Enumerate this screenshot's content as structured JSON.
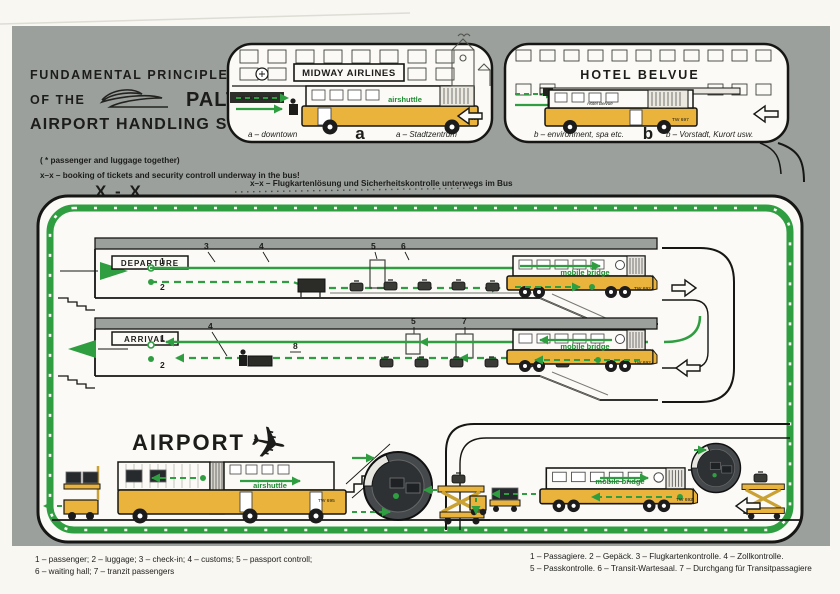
{
  "page": {
    "title1": "FUNDAMENTAL PRINCIPLES",
    "title2a": "OF THE",
    "title2b": "PALT *",
    "title3": "AIRPORT HANDLING SYSTEM",
    "note_star": "( * passenger and luggage together)",
    "note_xx_en": "x–x – booking of tickets and security controll underway in the bus!",
    "note_xx_big": "X - X",
    "note_xx_de": "x–x – Flugkartenlösung und Sicherheitskontrolle unterwegs im Bus"
  },
  "colors": {
    "page_gray": "#9ba09c",
    "green": "#2f9e41",
    "yellow": "#e9b33c",
    "ink": "#161614"
  },
  "scene_a": {
    "sign": "MIDWAY AIRLINES",
    "small_sign": "DEPARTURES",
    "bus_label": "airshuttle",
    "bus_number": "TW 696",
    "caption_left": "a – downtown",
    "letter": "a",
    "caption_right": "a – Stadtzentrum"
  },
  "scene_b": {
    "sign": "HOTEL BELVUE",
    "bus_side_text": "Hotel Belvue",
    "bus_number": "TW 697",
    "caption_left": "b – environment, spa etc.",
    "letter": "b",
    "caption_right": "b – Vorstadt, Kurort usw."
  },
  "departure": {
    "label": "DEPARTURE",
    "n1": "1",
    "n2": "2",
    "n3": "3",
    "n4": "4",
    "n5": "5",
    "n6": "6",
    "vehicle_label": "mobile bridge",
    "vehicle_number": "TW 692"
  },
  "arrival": {
    "label": "ARRIVAL",
    "n1": "1",
    "n2": "2",
    "n4": "4",
    "n5": "5",
    "n7": "7",
    "n8": "8",
    "vehicle_label": "mobile bridge",
    "vehicle_number": "TW 692"
  },
  "airport": {
    "label": "AIRPORT",
    "plane_icon": "✈"
  },
  "apron_left": {
    "bus_label": "airshuttle",
    "bus_number": "TW 695"
  },
  "apron_right": {
    "vehicle_label": "mobile bridge",
    "vehicle_number": "TW 692"
  },
  "legend_en": {
    "line1": "1 – passenger; 2 – luggage; 3 – check-in; 4 – customs; 5 – passport controll;",
    "line2": "6 – waiting hall; 7 – tranzit passengers"
  },
  "legend_de": {
    "line1": "1 – Passagiere. 2 – Gepäck. 3 – Flugkartenkontrolle. 4 – Zollkontrolle.",
    "line2": "5 – Passkontrolle. 6 – Transit-Wartesaal. 7 – Durchgang für Transitpassagiere"
  }
}
